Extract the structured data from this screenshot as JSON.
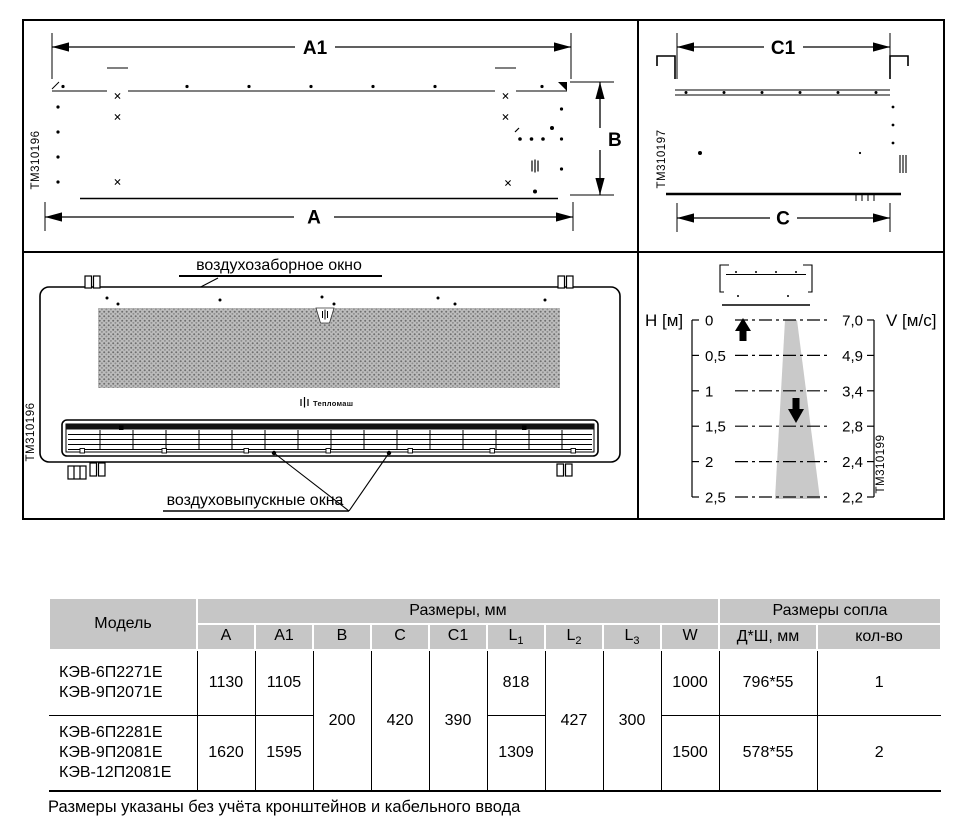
{
  "colors": {
    "line_black": "#000000",
    "table_header_bg": "#c6c6c6",
    "jet_cone_grey": "#c9c9c9",
    "mesh_grey": "#bdbdbd"
  },
  "panels": {
    "front": {
      "tm": "TM310196",
      "dim_a1": "A1",
      "dim_a": "A",
      "dim_b": "B"
    },
    "side": {
      "tm": "TM310197",
      "dim_c1": "C1",
      "dim_c": "C"
    },
    "bottom": {
      "tm": "TM310196",
      "intake_label": "воздухозаборное окно",
      "outlet_label": "воздуховыпускные окна",
      "logo": "Тепломаш"
    },
    "chart": {
      "tm": "TM310199",
      "h_axis": "H [м]",
      "v_axis": "V [м/с]",
      "levels": [
        {
          "h": "0",
          "v": "7,0"
        },
        {
          "h": "0,5",
          "v": "4,9"
        },
        {
          "h": "1",
          "v": "3,4"
        },
        {
          "h": "1,5",
          "v": "2,8"
        },
        {
          "h": "2",
          "v": "2,4"
        },
        {
          "h": "2,5",
          "v": "2,2"
        }
      ]
    }
  },
  "chart_data": {
    "type": "line",
    "title": "",
    "xlabel": "H [м]",
    "ylabel": "V [м/с]",
    "x": [
      0,
      0.5,
      1,
      1.5,
      2,
      2.5
    ],
    "values": [
      7.0,
      4.9,
      3.4,
      2.8,
      2.4,
      2.2
    ],
    "x_range": [
      0,
      2.5
    ],
    "y_range": [
      2.2,
      7.0
    ],
    "grid": "dashed horizontal levels",
    "legend_position": "none"
  },
  "table": {
    "header": {
      "model": "Модель",
      "dims_group": "Размеры, мм",
      "nozzle_group": "Размеры сопла"
    },
    "columns": [
      {
        "label": "A",
        "sub": ""
      },
      {
        "label": "A1",
        "sub": ""
      },
      {
        "label": "B",
        "sub": ""
      },
      {
        "label": "C",
        "sub": ""
      },
      {
        "label": "C1",
        "sub": ""
      },
      {
        "label": "L",
        "sub": "1"
      },
      {
        "label": "L",
        "sub": "2"
      },
      {
        "label": "L",
        "sub": "3"
      },
      {
        "label": "W",
        "sub": ""
      }
    ],
    "nozzle_columns": [
      {
        "label": "Д*Ш, мм"
      },
      {
        "label": "кол-во"
      }
    ],
    "shared": {
      "b": "200",
      "c": "420",
      "c1": "390",
      "l2": "427",
      "l3": "300"
    },
    "rows": [
      {
        "models": [
          "КЭВ-6П2271Е",
          "КЭВ-9П2071Е"
        ],
        "a": "1130",
        "a1": "1105",
        "l1": "818",
        "w": "1000",
        "nozzle": "796*55",
        "count": "1"
      },
      {
        "models": [
          "КЭВ-6П2281Е",
          "КЭВ-9П2081Е",
          "КЭВ-12П2081Е"
        ],
        "a": "1620",
        "a1": "1595",
        "l1": "1309",
        "w": "1500",
        "nozzle": "578*55",
        "count": "2"
      }
    ]
  },
  "note": "Размеры указаны без учёта кронштейнов и кабельного ввода"
}
